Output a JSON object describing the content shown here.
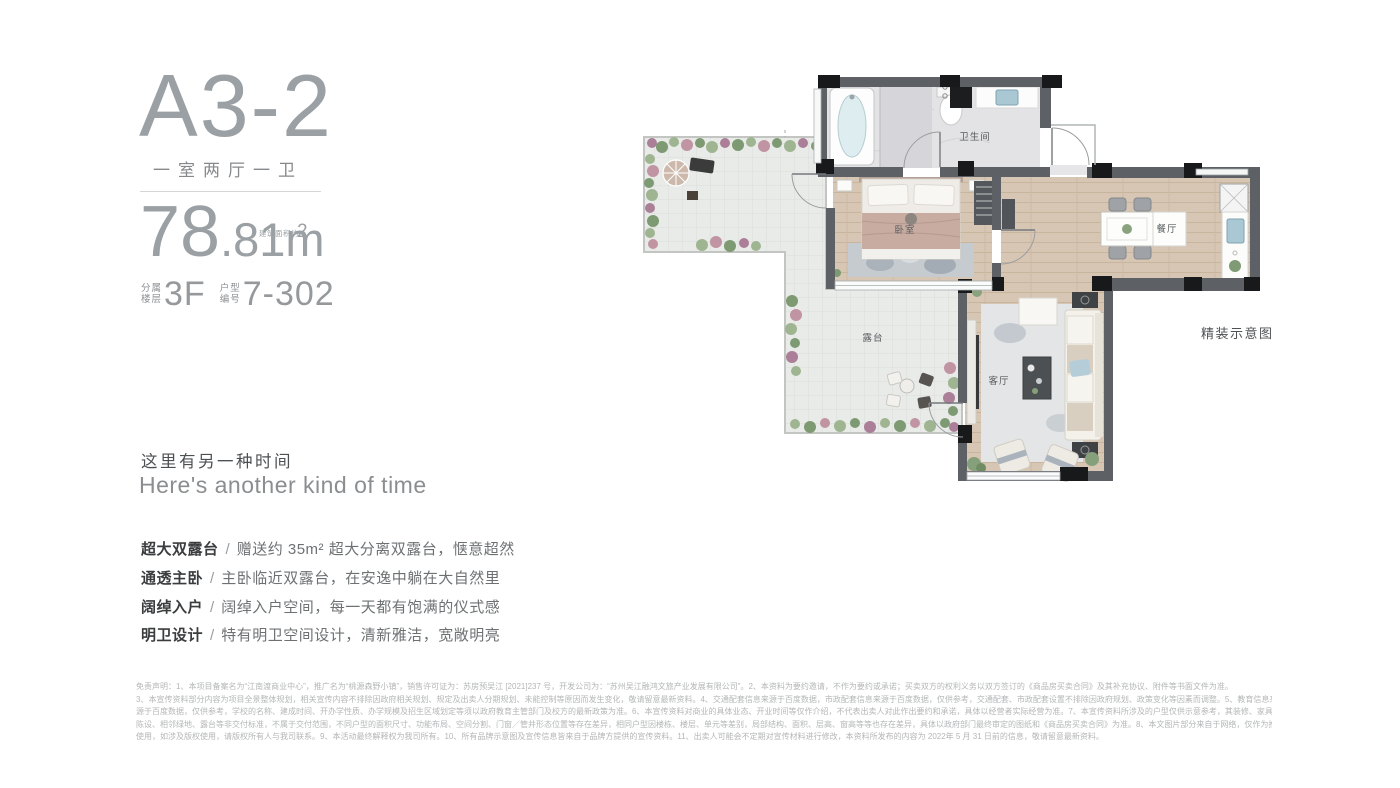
{
  "unit": {
    "name": "A3-2",
    "layout": "一室两厅一卫",
    "area": {
      "int": "78",
      "frac": ".81m",
      "sup": "2",
      "note": "建筑面积约",
      "full": "78.81m²"
    },
    "floor": {
      "label_top": "分属",
      "label_bottom": "楼层",
      "value": "3F"
    },
    "code": {
      "label_top": "户型",
      "label_bottom": "编号",
      "value": "7-302"
    }
  },
  "tagline": {
    "zh": "这里有另一种时间",
    "en": "Here's another kind of time"
  },
  "features": [
    {
      "label": "超大双露台",
      "sep": "/",
      "text": "赠送约 35m² 超大分离双露台，惬意超然"
    },
    {
      "label": "通透主卧",
      "sep": "/",
      "text": "主卧临近双露台，在安逸中躺在大自然里"
    },
    {
      "label": "阔绰入户",
      "sep": "/",
      "text": "阔绰入户空间，每一天都有饱满的仪式感"
    },
    {
      "label": "明卫设计",
      "sep": "/",
      "text": "特有明卫空间设计，清新雅洁，宽敞明亮"
    }
  ],
  "floorplan": {
    "caption": "精装示意图",
    "rooms": {
      "bathroom": "卫生间",
      "bedroom": "卧室",
      "dining": "餐厅",
      "living": "客厅",
      "terrace": "露台"
    }
  },
  "disclaimer": {
    "lines": [
      "免责声明：1、本项目备案名为“江南渡商业中心”，推广名为“桃源森野小镇”，销售许可证为：苏房预吴江 [2021]237 号，开发公司为：“苏州吴江融鸿文旅产业发展有限公司”。2、本资料为要约邀请，不作为要约或承诺；买卖双方的权利义务以双方签订的《商品房买卖合同》及其补充协议、附件等书面文件为准。",
      "3、本宣传资料部分内容为项目全景整体规划，相关宣传内容不排除因政府相关规划、规定及出卖人分期规划、未能控制等原因而发生变化，敬请留意最新资料。4、交通配套信息来源于百度数据，市政配套信息来源于百度数据，仅供参考，交通配套、市政配套设置不排除因政府规划、政策变化等因素而调整。5、教育信息来",
      "源于百度数据，仅供参考，学校的名称、建成时间、开办学性质、办学规模及招生区域划定等须以政府教育主管部门及校方的最新政策为准。6、本宣传资料对商业的具体业态、开业时间等仅作介绍，不代表出卖人对此作出要约和承诺，具体以经营者实际经营为准。7、本宣传资料所涉及的户型仅供示意参考，其装修、家具、",
      "陈设、相邻绿地、露台等非交付标准，不属于交付范围，不同户型的面积尺寸、功能布局、空间分割、门窗／管井形态位置等存在差异，相同户型因楼栋、楼层、单元等差别，局部结构、面积、层高、窗高等等也存在差异，具体以政府部门最终审定的图纸和《商品房买卖合同》为准。8、本文图片部分来自于网络，仅作为推广示意",
      "使用，如涉及版权使用，请版权所有人与我司联系。9、本活动最终解释权为我司所有。10、所有品牌示意图及宣传信息皆来自于品牌方提供的宣传资料。11、出卖人可能会不定期对宣传材料进行修改，本资料所发布的内容为 2022年 5 月 31 日前的信息，敬请留意最新资料。"
    ]
  },
  "colors": {
    "accent_gray": "#9aa0a3",
    "text_dark": "#3a3c3e",
    "text_body": "#6e7173",
    "disclaimer_gray": "#b4b6b7",
    "wall": "#5d6165",
    "column": "#17191a",
    "wood_floor": "#d6c6b3",
    "terrace_floor": "#e9ebe8",
    "bath_floor": "#e3e3e6",
    "plant_green": "#7e9a72",
    "plant_pink": "#c094a3",
    "water_blue": "#a9c8d4"
  }
}
